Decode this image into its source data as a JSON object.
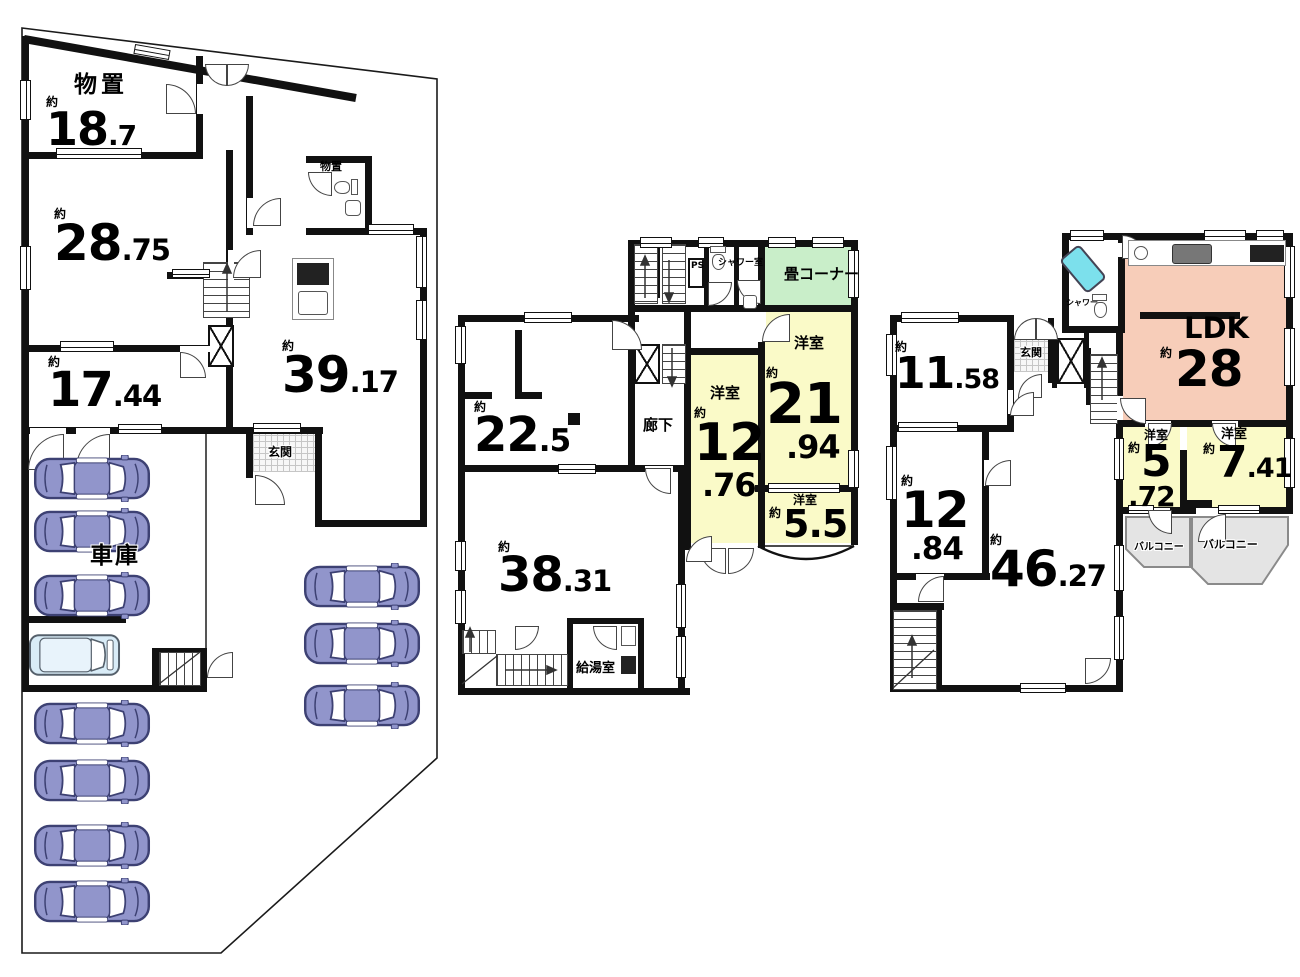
{
  "document": {
    "type": "floor-plan-diagram"
  },
  "colors": {
    "wall": "#111111",
    "room_yellow": "#fafac8",
    "room_green": "#c9eec9",
    "room_pink": "#f7cdb9",
    "balcony_gray": "#e4e4e4",
    "car_purple": "#9195cb",
    "van_blue": "#d9ecf7",
    "tub_cyan": "#7ce0ec"
  },
  "icons": {
    "car": "sedan-car-top-icon",
    "van": "van-top-icon",
    "toilet": "toilet-icon",
    "sink": "sink-icon",
    "bathtub": "bathtub-icon",
    "kitchen_counter": "kitchen-counter-icon",
    "stove": "stove-icon",
    "elevator": "elevator-icon",
    "stairs": "stairs-icon"
  },
  "plans": {
    "left": {
      "rooms": {
        "storage": {
          "name": "物置",
          "approx": "約",
          "int": "18",
          "dec": ".7"
        },
        "r2875": {
          "approx": "約",
          "int": "28",
          "dec": ".75"
        },
        "r1744": {
          "approx": "約",
          "int": "17",
          "dec": ".44"
        },
        "r3917": {
          "approx": "約",
          "int": "39",
          "dec": ".17"
        },
        "entrance": {
          "name": "玄関"
        },
        "garage": {
          "name": "車庫"
        },
        "storage_small": {
          "name": "物置"
        }
      }
    },
    "middle": {
      "rooms": {
        "r225": {
          "approx": "約",
          "int": "22",
          "dec": ".5"
        },
        "r3831": {
          "approx": "約",
          "int": "38",
          "dec": ".31"
        },
        "corridor": {
          "name": "廊下"
        },
        "w1276": {
          "name": "洋室",
          "approx": "約",
          "int": "12",
          "dec": ".76"
        },
        "w2194": {
          "name": "洋室",
          "approx": "約",
          "int": "21",
          "dec": ".94"
        },
        "tatami": {
          "name": "畳コーナー"
        },
        "w55": {
          "name": "洋室",
          "approx": "約",
          "int": "5.5",
          "dec": ""
        },
        "shower": {
          "name": "シャワー室"
        },
        "ps": {
          "name": "PS"
        },
        "kitchenette": {
          "name": "給湯室"
        }
      }
    },
    "right": {
      "rooms": {
        "r1158": {
          "approx": "約",
          "int": "11",
          "dec": ".58"
        },
        "r1284": {
          "approx": "約",
          "int": "12",
          "dec": ".84"
        },
        "r4627": {
          "approx": "約",
          "int": "46",
          "dec": ".27"
        },
        "ldk": {
          "name": "LDK",
          "approx": "約",
          "int": "28",
          "dec": ""
        },
        "w572": {
          "name": "洋室",
          "approx": "約",
          "int": "5",
          "dec": ".72"
        },
        "w741": {
          "name": "洋室",
          "approx": "約",
          "int": "7",
          "dec": ".41"
        },
        "entrance": {
          "name": "玄関"
        },
        "shower": {
          "name": "シャワー"
        },
        "balcony1": {
          "name": "バルコニー"
        },
        "balcony2": {
          "name": "バルコニー"
        }
      }
    }
  }
}
